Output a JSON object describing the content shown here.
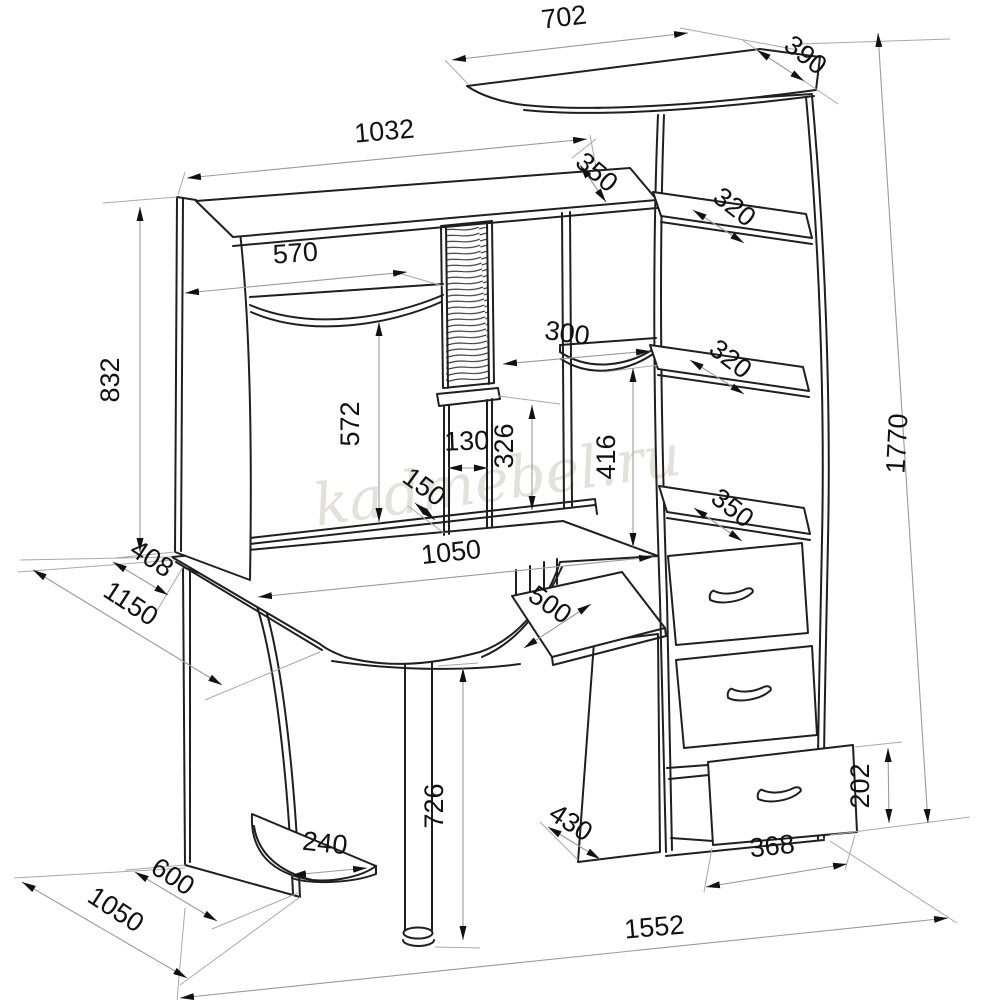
{
  "drawing": {
    "watermark": "kadmebel.ru",
    "top_shelf": {
      "width": "702",
      "depth": "390"
    },
    "hutch": {
      "width": "1032",
      "depth": "350",
      "height": "832",
      "shelf_width": "570",
      "cd_rack_height": "572",
      "divider_gap": "130",
      "divider_depth": "150",
      "corner_shelf_depth": "300",
      "niche_height": "326",
      "right_niche_height": "416"
    },
    "tower": {
      "shelf_top_depth": "320",
      "shelf_mid_depth": "320",
      "shelf_bottom_depth": "350",
      "drawer_width": "368",
      "drawer_height": "202"
    },
    "desk": {
      "width": "1050",
      "tray_width": "500",
      "leg_height": "726",
      "back_offset": "408",
      "diagonal_depth": "1150",
      "pedestal_depth": "600",
      "left_total_depth": "1050",
      "bottom_shelf_depth": "240",
      "right_pedestal_depth": "430"
    },
    "overall": {
      "height": "1770",
      "width": "1552"
    }
  }
}
